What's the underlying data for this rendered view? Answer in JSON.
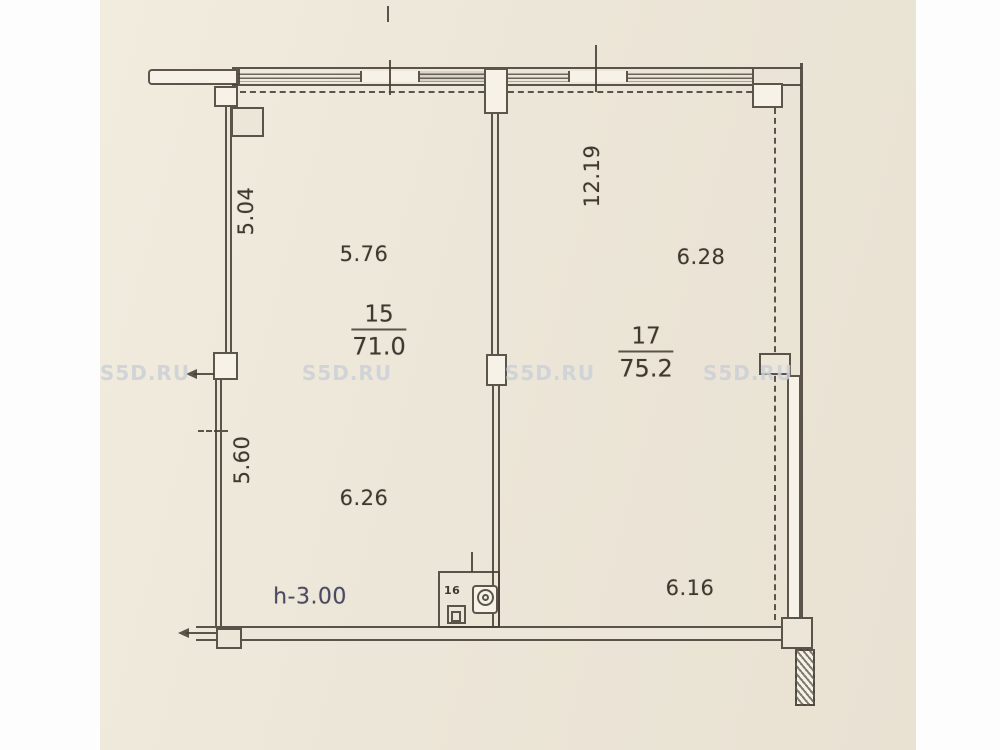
{
  "watermark": {
    "text": "S5D.RU"
  },
  "plan": {
    "rooms": {
      "living": {
        "number": "15",
        "area": "71.0"
      },
      "hall": {
        "number": "17",
        "area": "75.2"
      },
      "bath": {
        "number": "16"
      }
    },
    "dimensions": {
      "left_wall_upper": "5.04",
      "room15_top": "5.76",
      "right_wall_vertical": "12.19",
      "room17_top": "6.28",
      "left_wall_lower": "5.60",
      "room15_bottom": "6.26",
      "room17_bottom": "6.16"
    },
    "height_note": "h-3.00"
  }
}
